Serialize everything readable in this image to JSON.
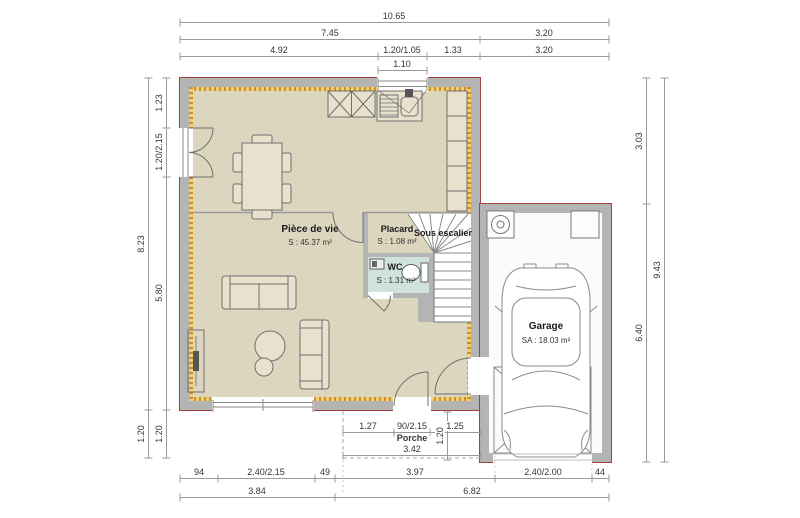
{
  "title": "floor-plan",
  "colors": {
    "wall": "#b4b4b4",
    "exterior_outline": "#a3423b",
    "floor": "#ddd6bf",
    "insulation_dark": "#c89030",
    "insulation_light": "#f3cf70",
    "wc_floor": "#cfe2dd",
    "garage_floor": "#fbfbfb",
    "dimension_line": "#999999",
    "dimension_text": "#333333"
  },
  "dims": {
    "top": {
      "total": "10.65",
      "house": "7.45",
      "garage": "3.20",
      "seg1": "4.92",
      "window": "1.20/1.05",
      "seg2": "1.33",
      "garage2": "3.20",
      "rough": "1.10"
    },
    "left": {
      "seg1": "1.23",
      "door": "1.20/2.15",
      "total": "8.23",
      "seg2": "5.80",
      "porch_outer": "1.20",
      "porch_inner": "1.20"
    },
    "right": {
      "upper": "3.03",
      "total": "9.43",
      "lower": "6.40"
    },
    "porch": {
      "seg1": "1.27",
      "door": "90/2.15",
      "seg2": "1.25",
      "label": "Porche",
      "width": "3.42",
      "depth": "1.20"
    },
    "bottom": {
      "seg1": "94",
      "window": "2.40/2.15",
      "seg2": "49",
      "seg3": "3.97",
      "garage_door": "2.40/2.00",
      "seg4": "44",
      "left_total": "3.84",
      "right_total": "6.82"
    }
  },
  "rooms": {
    "living": {
      "label": "Pièce de vie",
      "area": "S : 45.37 m²"
    },
    "placard": {
      "label": "Placard",
      "area": "S : 1.08 m²"
    },
    "under_stairs": {
      "label": "Sous escalier"
    },
    "wc": {
      "label": "WC",
      "area": "S : 1.31 m²"
    },
    "garage": {
      "label": "Garage",
      "area": "SA : 18.03 m²"
    }
  }
}
